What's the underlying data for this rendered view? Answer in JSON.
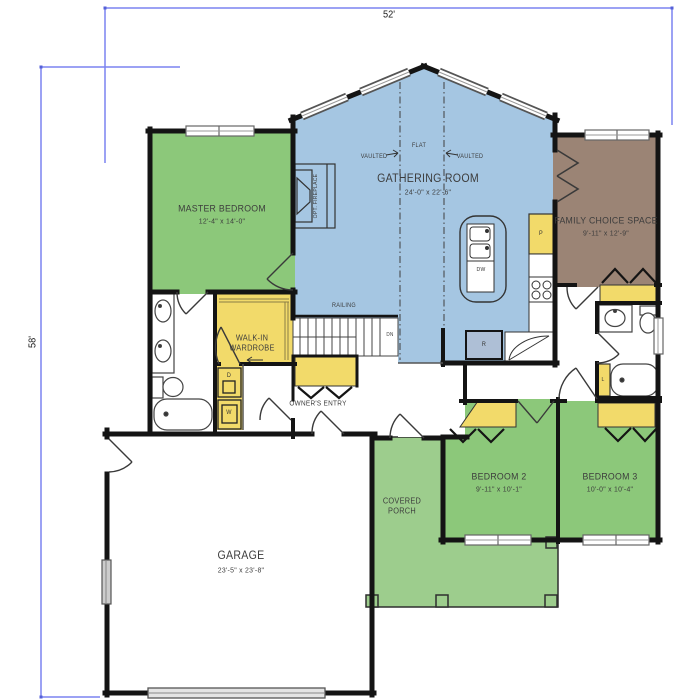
{
  "plan": {
    "title": "single-story floor plan",
    "dim_width": "52'",
    "dim_height": "58'"
  },
  "rooms": {
    "master": {
      "name": "MASTER BEDROOM",
      "size": "12'-4\" x 14'-0\""
    },
    "gathering": {
      "name": "GATHERING ROOM",
      "size": "24'-0\" x 22'-6\""
    },
    "family": {
      "name": "FAMILY CHOICE SPACE",
      "size": "9'-11\" x 12'-9\""
    },
    "bedroom2": {
      "name": "BEDROOM 2",
      "size": "9'-11\" x 10'-1\""
    },
    "bedroom3": {
      "name": "BEDROOM 3",
      "size": "10'-0\" x 10'-4\""
    },
    "garage": {
      "name": "GARAGE",
      "size": "23'-5\" x 23'-8\""
    },
    "porch": {
      "name": "COVERED PORCH"
    },
    "walkin": {
      "name": "WALK-IN WARDROBE"
    },
    "owners_entry": {
      "name": "OWNER'S ENTRY"
    }
  },
  "annotations": {
    "flat": "FLAT",
    "vaulted_left": "VAULTED",
    "vaulted_right": "VAULTED",
    "railing": "RAILING",
    "down": "DN",
    "fireplace": "OPT. FIREPLACE"
  },
  "appliances": {
    "pantry": "P",
    "dishwasher": "DW",
    "refrigerator": "R",
    "dryer": "D",
    "washer": "W",
    "linen": "L"
  },
  "colors": {
    "bedroom_green": "#8cc87a",
    "porch_green": "#9dcd8d",
    "gathering_blue": "#a5c6e2",
    "family_brown": "#9b8475",
    "closet_yellow": "#f2da6a",
    "wall_black": "#141414",
    "dimension_blue": "#7b83f0",
    "appliance_blue": "#aebfd6",
    "window_gray": "#b9b9b9"
  }
}
